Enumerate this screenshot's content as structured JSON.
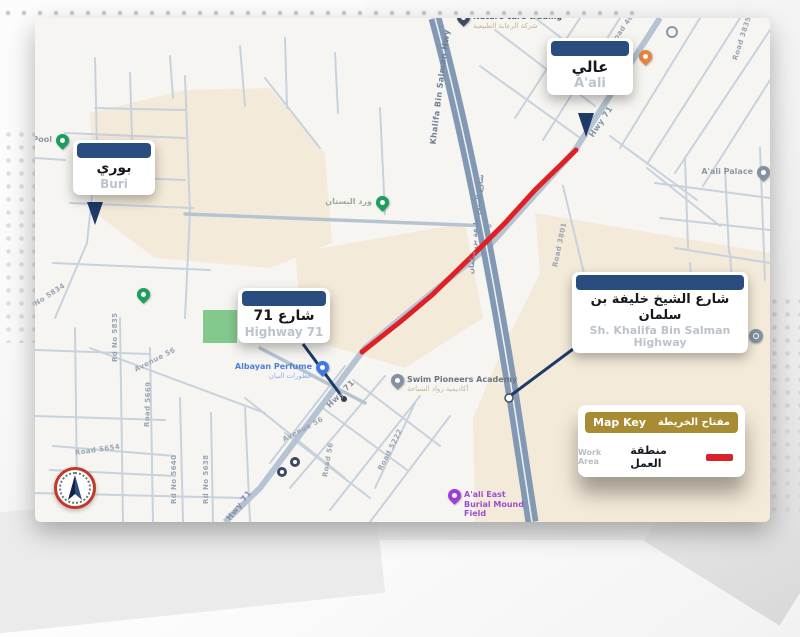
{
  "page": {
    "type": "roadworks-advisory-map"
  },
  "colors": {
    "callout_header_blue": "#2a4d80",
    "pointer_navy": "#1e3a66",
    "work_area_red": "#df2127",
    "legend_gold": "#a78c33",
    "highway_fill": "#8399b3",
    "road_fill": "#c7d2dd",
    "beige_area": "#f4ead9",
    "park_green": "#83c98e"
  },
  "callouts": [
    {
      "id": "aali",
      "ar": "عالي",
      "en": "A'ali"
    },
    {
      "id": "buri",
      "ar": "بوري",
      "en": "Buri"
    },
    {
      "id": "hwy71",
      "ar": "شارع 71",
      "en": "Highway 71"
    },
    {
      "id": "khalifa",
      "ar": "شارع الشيخ خليفة بن سلمان",
      "en": "Sh. Khalifa Bin Salman Highway"
    }
  ],
  "legend": {
    "title_en": "Map Key",
    "title_ar": "مفتاح الخريطة",
    "item_en": "Work Area",
    "item_ar": "منطقة العمل"
  },
  "pois": [
    {
      "id": "nature-care-trading",
      "x": 428,
      "y": 8,
      "pin": "navy",
      "pin_color": "#3c4a63",
      "side": "right",
      "name": "Nature care trading",
      "ar": "شركة الرعاية الطبيعية",
      "name_color": "#4e5a66",
      "ar_color": "#c3b49b"
    },
    {
      "id": "map-target",
      "x": 636,
      "y": 13,
      "pin": "ring"
    },
    {
      "id": "restaurant",
      "x": 610,
      "y": 47,
      "pin": "poi",
      "pin_color": "#e8823c"
    },
    {
      "id": "aali-palace",
      "x": 728,
      "y": 163,
      "pin": "poi",
      "pin_color": "#8292a3",
      "side": "left",
      "name": "A'ali Palace",
      "name_color": "#8b99a6"
    },
    {
      "id": "ward-albustan",
      "x": 347,
      "y": 193,
      "pin": "poi",
      "pin_color": "#1e9e5c",
      "side": "left",
      "name": "ورد البستان",
      "name_color": "#9aaa9c"
    },
    {
      "id": "pool",
      "x": 27,
      "y": 131,
      "pin": "poi",
      "pin_color": "#1e9e5c",
      "side": "left",
      "name": "Pool",
      "name_color": "#8b99a6"
    },
    {
      "id": "green-poi",
      "x": 108,
      "y": 285,
      "pin": "poi",
      "pin_color": "#1e9e5c"
    },
    {
      "id": "albayan-perfume",
      "x": 287,
      "y": 358,
      "pin": "poi",
      "pin_color": "#4178e3",
      "side": "left",
      "name": "Albayan Perfume",
      "ar": "عطورات البيان",
      "name_color": "#4b7fd6",
      "ar_color": "#90b1e8"
    },
    {
      "id": "swim-pioneers-academy",
      "x": 362,
      "y": 371,
      "pin": "poi",
      "pin_color": "#8292a3",
      "side": "right",
      "name": "Swim Pioneers Academy",
      "ar": "أكاديمية رواد السباحة",
      "name_color": "#6a7684",
      "ar_color": "#c3b49b"
    },
    {
      "id": "burial-mounds",
      "x": 721,
      "y": 323,
      "pin": "circle",
      "side": "left",
      "name": "Burial Mounds",
      "ar": "مقابر عالي الأثرية",
      "name_color": "#98a1ab",
      "ar_color": "#c3b49b"
    },
    {
      "id": "aali-east-burial-mound-field",
      "x": 419,
      "y": 486,
      "pin": "poi",
      "pin_color": "#a13dd6",
      "side": "right",
      "name": "A'ali East Burial Mound Field",
      "name_color": "#9b4fd1",
      "wrap": 70
    },
    {
      "id": "transit-stop-1",
      "x": 247,
      "y": 454,
      "pin": "transit"
    },
    {
      "id": "transit-stop-2",
      "x": 260,
      "y": 444,
      "pin": "transit"
    }
  ],
  "road_labels": [
    {
      "t": "Khalifa Bin Salman Hwy",
      "x": 398,
      "y": 122,
      "r": -83,
      "c": "#6f8098",
      "s": 8
    },
    {
      "t": "شارع الشيخ خليفة بن سلمان",
      "x": 436,
      "y": 252,
      "r": -84,
      "c": "#7d8fa6",
      "s": 7
    },
    {
      "t": "Hwy 71",
      "x": 556,
      "y": 114,
      "r": -56,
      "c": "#8593a4",
      "s": 8
    },
    {
      "t": "Hwy 71",
      "x": 293,
      "y": 384,
      "r": -45,
      "c": "#8593a4",
      "s": 8
    },
    {
      "t": "Hwy 71",
      "x": 193,
      "y": 497,
      "r": -52,
      "c": "#8593a4",
      "s": 8
    },
    {
      "t": "Road 4022",
      "x": 577,
      "y": 22,
      "r": -55,
      "c": "#98a5b3",
      "s": 7
    },
    {
      "t": "Road 3835",
      "x": 700,
      "y": 38,
      "r": -72,
      "c": "#98a5b3",
      "s": 7
    },
    {
      "t": "Road 3801",
      "x": 520,
      "y": 245,
      "r": -78,
      "c": "#98a5b3",
      "s": 7
    },
    {
      "t": "Rd No 5835",
      "x": 80,
      "y": 340,
      "r": -90,
      "c": "#98a5b3",
      "s": 7
    },
    {
      "t": "Avenue 56",
      "x": 100,
      "y": 348,
      "r": -27,
      "c": "#98a5b3",
      "s": 7
    },
    {
      "t": "Road 5669",
      "x": 112,
      "y": 405,
      "r": -88,
      "c": "#98a5b3",
      "s": 7
    },
    {
      "t": "Rd No 5640",
      "x": 139,
      "y": 482,
      "r": -90,
      "c": "#98a5b3",
      "s": 7
    },
    {
      "t": "Rd No 5638",
      "x": 171,
      "y": 482,
      "r": -90,
      "c": "#98a5b3",
      "s": 7
    },
    {
      "t": "Avenue 56",
      "x": 248,
      "y": 418,
      "r": -28,
      "c": "#98a5b3",
      "s": 7
    },
    {
      "t": "Road 56",
      "x": 290,
      "y": 455,
      "r": -80,
      "c": "#98a5b3",
      "s": 7
    },
    {
      "t": "Road 5654",
      "x": 40,
      "y": 431,
      "r": -8,
      "c": "#98a5b3",
      "s": 7
    },
    {
      "t": "Road 5222",
      "x": 345,
      "y": 448,
      "r": -63,
      "c": "#98a5b3",
      "s": 7
    },
    {
      "t": "Rd No 5834",
      "x": -12,
      "y": 290,
      "r": -33,
      "c": "#98a5b3",
      "s": 7
    }
  ]
}
